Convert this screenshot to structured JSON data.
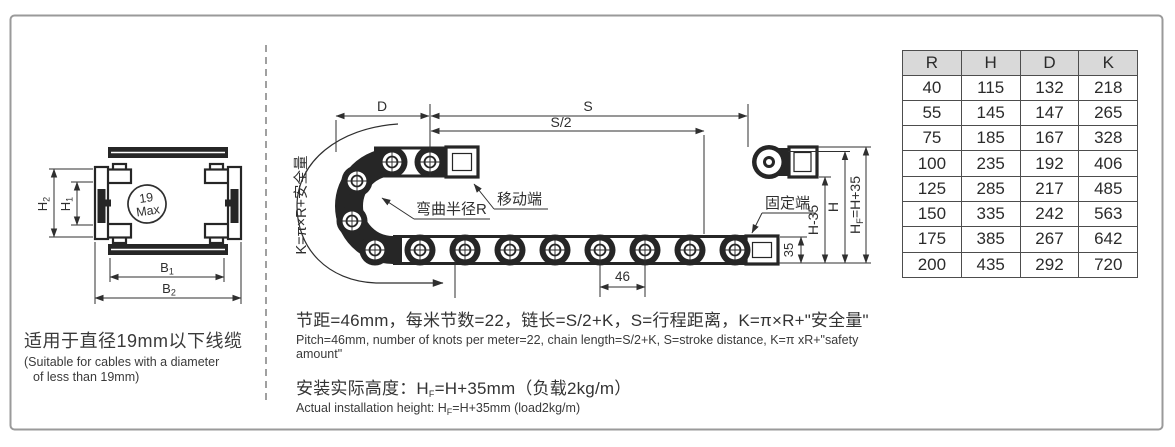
{
  "left_view": {
    "circle_line1": "19",
    "circle_line2": "Max",
    "dim_h2": {
      "base": "H",
      "sub": "2"
    },
    "dim_h1": {
      "base": "H",
      "sub": "1"
    },
    "dim_b1": {
      "base": "B",
      "sub": "1"
    },
    "dim_b2": {
      "base": "B",
      "sub": "2"
    },
    "caption_cn": "适用于直径19mm以下线缆",
    "caption_en_line1": "(Suitable for cables with a diameter",
    "caption_en_line2": "of less than 19mm)"
  },
  "diagram": {
    "dim_d": "D",
    "dim_s": "S",
    "dim_s2": "S/2",
    "dim_46": "46",
    "dim_35": "35",
    "dim_h_minus_35": "H-35",
    "dim_h": "H",
    "dim_hf": {
      "pre": "H",
      "sub": "F",
      "post": "=H+35"
    },
    "k_formula": "K=π×R+安全量",
    "bend_radius_label": "弯曲半径R",
    "moving_end_label": "移动端",
    "fixed_end_label": "固定端"
  },
  "notes": {
    "pitch_cn": "节距=46mm，每米节数=22，链长=S/2+K，S=行程距离，K=π×R+\"安全量\"",
    "pitch_en": "Pitch=46mm, number of knots per meter=22, chain length=S/2+K, S=stroke distance, K=π xR+\"safety amount\"",
    "height_cn_pre": "安装实际高度：H",
    "height_sub": "F",
    "height_cn_post": "=H+35mm（负载2kg/m）",
    "height_en_pre": "Actual installation height: H",
    "height_en_sub": "F",
    "height_en_post": "=H+35mm (load2kg/m)"
  },
  "table": {
    "headers": [
      "R",
      "H",
      "D",
      "K"
    ],
    "rows": [
      [
        "40",
        "115",
        "132",
        "218"
      ],
      [
        "55",
        "145",
        "147",
        "265"
      ],
      [
        "75",
        "185",
        "167",
        "328"
      ],
      [
        "100",
        "235",
        "192",
        "406"
      ],
      [
        "125",
        "285",
        "217",
        "485"
      ],
      [
        "150",
        "335",
        "242",
        "563"
      ],
      [
        "175",
        "385",
        "267",
        "642"
      ],
      [
        "200",
        "435",
        "292",
        "720"
      ]
    ]
  },
  "colors": {
    "line": "#2f2f2f",
    "chain_dark": "#262626",
    "table_header_bg": "#d9d9d9",
    "panel_border": "#9a9a9a"
  }
}
